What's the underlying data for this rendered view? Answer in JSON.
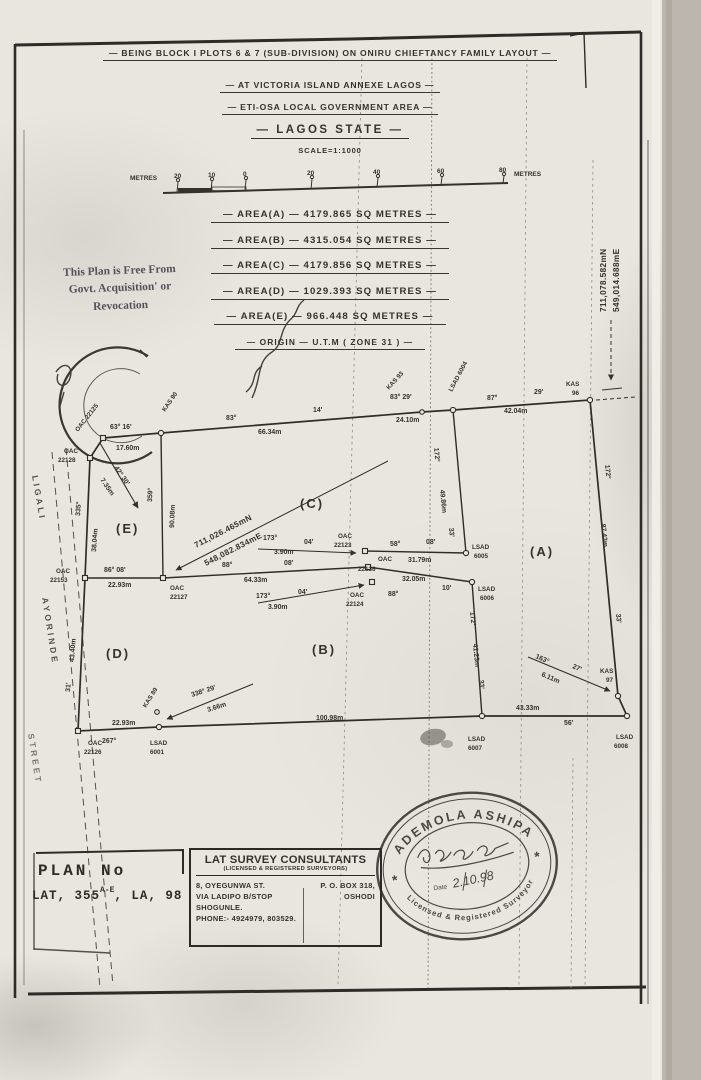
{
  "colors": {
    "ink": "#35322e",
    "paper": "#e9e6e0",
    "margin_strip": "#bcb6ae",
    "note_gray": "#54525a",
    "stamp_gray": "#4a4744"
  },
  "header": {
    "line1": "— BEING BLOCK I PLOTS 6 & 7 (SUB-DIVISION) ON ONIRU CHIEFTANCY FAMILY LAYOUT —",
    "line2": "— AT VICTORIA ISLAND ANNEXE LAGOS —",
    "line3": "— ETI-OSA LOCAL GOVERNMENT AREA —",
    "line4": "— LAGOS STATE —",
    "scale": "SCALE=1:1000"
  },
  "scalebar": {
    "unit_left": "METRES",
    "t0": "20",
    "t1": "10",
    "t2": "0",
    "t3": "20",
    "t4": "40",
    "t5": "60",
    "t6": "80",
    "unit_right": "METRES"
  },
  "areas": {
    "a": "— AREA(A) — 4179.865 SQ METRES —",
    "b": "— AREA(B) — 4315.054 SQ METRES —",
    "c": "— AREA(C) — 4179.856 SQ METRES —",
    "d": "— AREA(D) — 1029.393 SQ METRES —",
    "e": "— AREA(E) — 966.448 SQ METRES —",
    "origin": "— ORIGIN — U.T.M ( ZONE 31 ) —"
  },
  "note": {
    "l1": "This Plan is Free From",
    "l2": "Govt. Acquisition' or",
    "l3": "Revocation"
  },
  "coords": {
    "right_n": "711,078.582mN",
    "right_e": "549,014.688mE",
    "center_n": "711,026.465mN",
    "center_e": "548,082.834mE"
  },
  "street": {
    "w1": "LIGALI",
    "w2": "AYORINDE",
    "w3": "STREET"
  },
  "plots": {
    "a": "(A)",
    "b": "(B)",
    "c": "(C)",
    "d": "(D)",
    "e": "(E)"
  },
  "beacons": {
    "oac22125": {
      "label": "OAC 22125"
    },
    "kas90": {
      "label": "KAS 90"
    },
    "kas93": {
      "label": "KAS 93"
    },
    "lsad6004": {
      "label": "LSAD 6004"
    },
    "kas89": {
      "label": "KAS 89"
    },
    "kas96": {
      "t": "KAS",
      "n": "96"
    },
    "kas97": {
      "t": "KAS",
      "n": "97"
    },
    "oac22128": {
      "t": "OAC",
      "n": "22128"
    },
    "oac22153": {
      "t": "OAC",
      "n": "22153"
    },
    "oac22127": {
      "t": "OAC",
      "n": "22127"
    },
    "oac22126": {
      "t": "OAC",
      "n": "22126"
    },
    "oac22123": {
      "t": "OAC",
      "n": "22123"
    },
    "oac22136": {
      "t": "OAC",
      "n": "22136"
    },
    "oac22124": {
      "t": "OAC",
      "n": "22124"
    },
    "lsad6001": {
      "t": "LSAD",
      "n": "6001"
    },
    "lsad6005": {
      "t": "LSAD",
      "n": "6005"
    },
    "lsad6006": {
      "t": "LSAD",
      "n": "6006"
    },
    "lsad6007": {
      "t": "LSAD",
      "n": "6007"
    },
    "lsad6008": {
      "t": "LSAD",
      "n": "6008"
    }
  },
  "dims": {
    "b63_16": "63° 16'",
    "d17_60": "17.60m",
    "b83": "83°",
    "b14": "14'",
    "d66_34": "66.34m",
    "b83_29": "83° 29'",
    "d24_10": "24.10m",
    "b87": "87°",
    "b29": "29'",
    "d42_04": "42.04m",
    "b172a": "172°",
    "d49_86": "49.86m",
    "b33a": "33'",
    "b172b": "172°",
    "d87_43": "87.43m",
    "b33b": "33'",
    "b172c": "172°",
    "d41_23": "41.23m",
    "b33c": "33'",
    "b359": "359°",
    "d90_08": "90.08m",
    "b335": "335°",
    "d38_04": "38.04m",
    "d43_40": "43.40m",
    "b31": "31'",
    "b42_30": "42° 30'",
    "d7_35": "7.35m",
    "b86_08": "86° 08'",
    "d22_93a": "22.93m",
    "b88a": "88°",
    "b08a": "08'",
    "d64_33": "64.33m",
    "b58": "58°",
    "b08b": "08'",
    "d31_79": "31.79m",
    "b88b": "88°",
    "b10": "10'",
    "d32_05": "32.05m",
    "b173a": "173°",
    "b04a": "04'",
    "d3_90a": "3.90m",
    "b173b": "173°",
    "b04b": "04'",
    "d3_90b": "3.90m",
    "b338_29": "338° 29'",
    "d3_66": "3.66m",
    "b163": "163°",
    "b27": "27'",
    "d6_11": "6.11m",
    "b267": "267°",
    "d22_93b": "22.93m",
    "d100_98": "100.98m",
    "d43_33": "43.33m",
    "b56": "56'"
  },
  "plan_no": {
    "title": "PLAN No",
    "pre": "LAT, 355",
    "sup": "A-E",
    "post": ", LA, 98"
  },
  "surveyor": {
    "name": "LAT SURVEY CONSULTANTS",
    "subtitle": "(LICENSED & REGISTERED SURVEYORS)",
    "addr1l": "8, OYEGUNWA ST.",
    "addr1r": "P. O. BOX 318,",
    "addr2l": "VIA LADIPO B/STOP",
    "addr2r": "OSHODI",
    "addr3": "SHOGUNLE.",
    "phone": "PHONE:- 4924979, 803529."
  },
  "stamp": {
    "name": "ADEMOLA ASHIPA",
    "star_l": "*",
    "star_r": "*",
    "date_label": "Date",
    "date": "2.10.98",
    "title": "Licensed & Registered Surveyor"
  }
}
